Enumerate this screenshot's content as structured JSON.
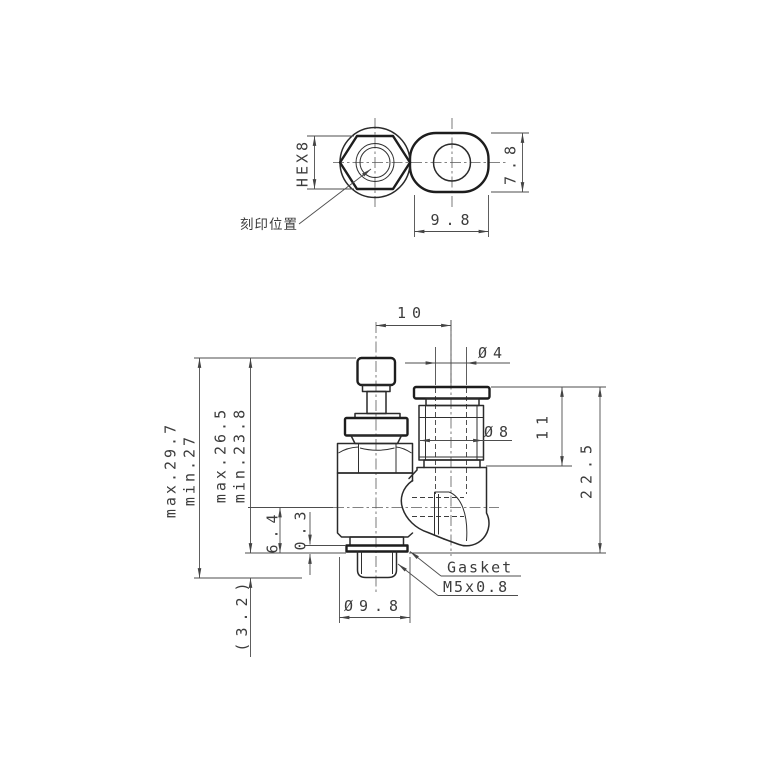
{
  "colors": {
    "line": "#2a2a2a",
    "dimension": "#4d4d4d",
    "text": "#3c3c3c",
    "background": "#ffffff"
  },
  "top_view": {
    "hex_size": "HEX8",
    "marking_position_label": "刻印位置",
    "slot_length": "9.8",
    "slot_height": "7.8"
  },
  "front_view": {
    "overall_height_max": "max.29.7",
    "overall_height_min": "min.27",
    "body_height_max": "max.26.5",
    "body_height_min": "min.23.8",
    "port_center_height": "6.4",
    "gasket_protrusion": "0.3",
    "thread_length": "(3.2)",
    "body_diameter": "Ø9.8",
    "port_offset": "10",
    "tube_diameter": "Ø4",
    "fitting_diameter": "Ø8",
    "fitting_height": "11",
    "side_overall_height": "22.5",
    "gasket_label": "Gasket",
    "thread_spec": "M5x0.8"
  }
}
